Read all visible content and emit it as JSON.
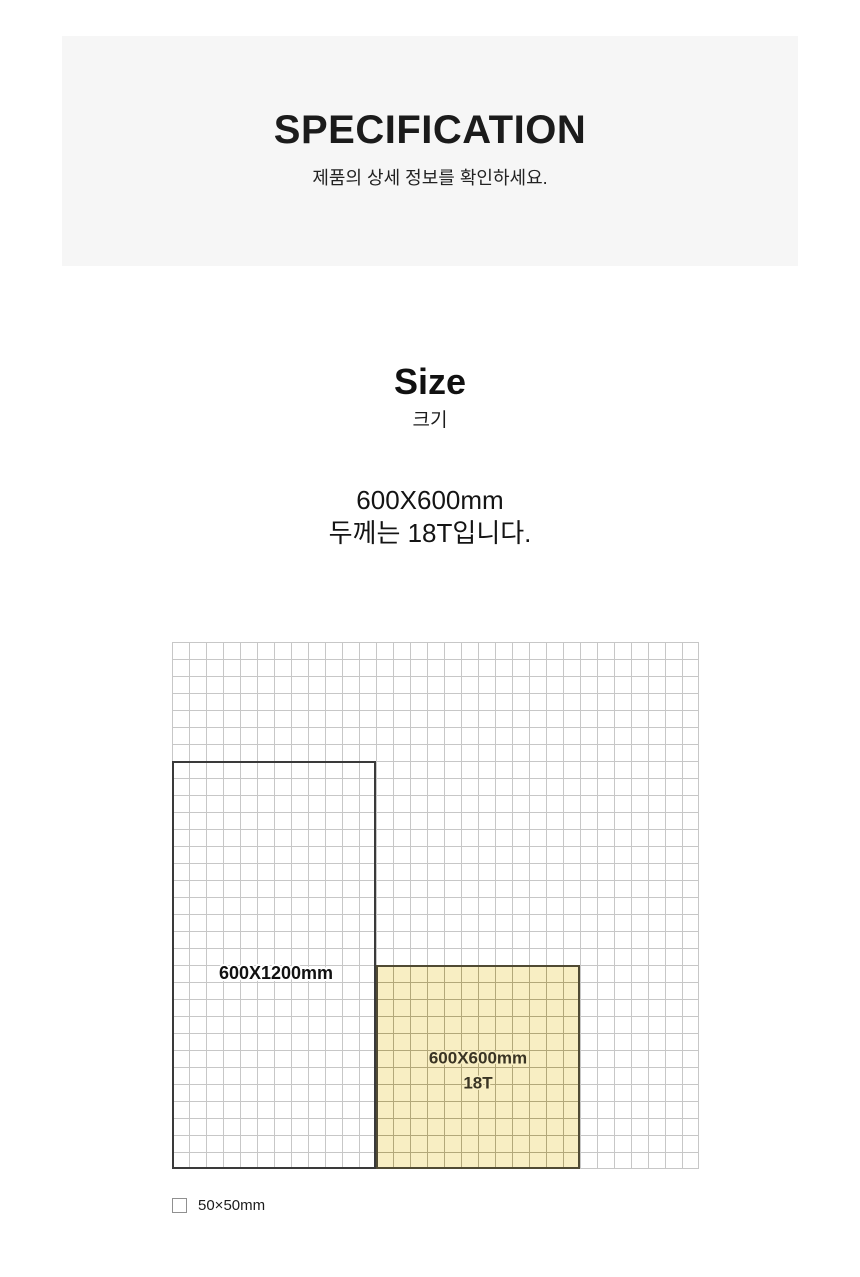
{
  "header": {
    "title": "SPECIFICATION",
    "subtitle": "제품의 상세 정보를 확인하세요."
  },
  "size_section": {
    "title": "Size",
    "subtitle": "크기",
    "spec_line1": "600X600mm",
    "spec_line2": "두께는 18T입니다."
  },
  "diagram": {
    "grid": {
      "columns": 31,
      "rows": 31,
      "cell_size_label": "50×50mm",
      "line_color": "#c7c7c7"
    },
    "panels": [
      {
        "label": "600X1200mm",
        "cols": 12,
        "rows": 24,
        "fill": "none",
        "border_color": "#3a3a3a",
        "label_color": "#111111"
      },
      {
        "label": "600X600mm",
        "sublabel": "18T",
        "cols": 12,
        "rows": 12,
        "fill": "#f8eec3",
        "inner_line_color": "#b3a87a",
        "border_color": "#504a33",
        "label_color": "#3a3424"
      }
    ],
    "legend": {
      "label": "50×50mm"
    }
  },
  "colors": {
    "page_background": "#ffffff",
    "header_band_background": "#f6f6f6",
    "text_primary": "#1b1b1b"
  }
}
